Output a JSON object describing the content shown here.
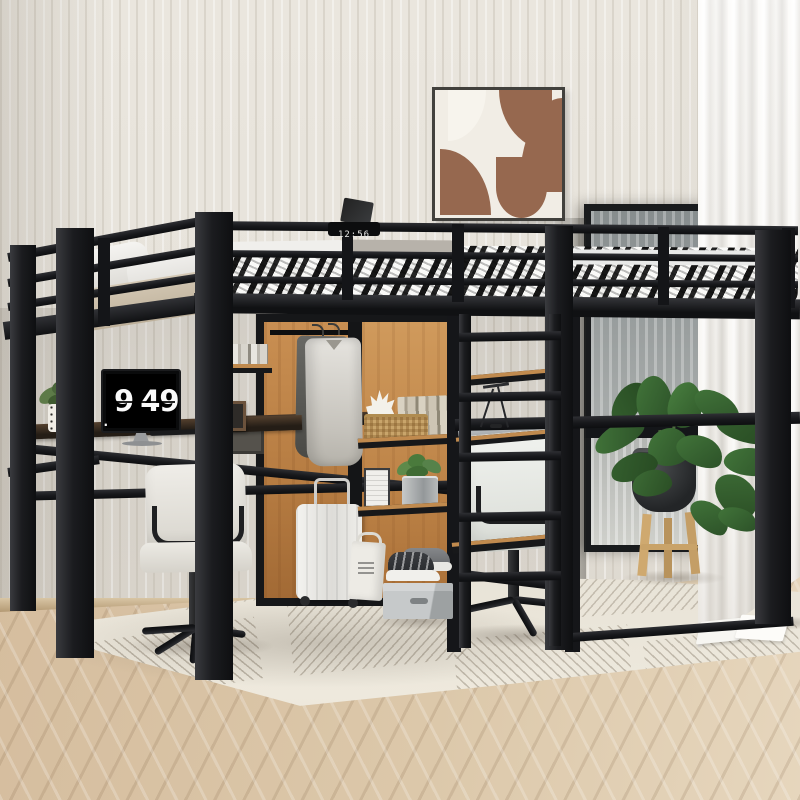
{
  "scene": {
    "title": "Black metal full-size loft bed with desks, wardrobe and shelves underneath",
    "setting": "bright bedroom with striped wallpaper, herringbone wood floor, cream area rug and a sheer-curtained black-framed window"
  },
  "bed": {
    "rail_clock_time": "12:56",
    "bedding": "black and white plaid comforter",
    "pillows": [
      "white",
      "tan"
    ],
    "frame": "black metal with guardrails and front ladder"
  },
  "monitor_clock": {
    "dot": ".",
    "hour": "9",
    "minute": "49"
  },
  "objects": {
    "left_desk": [
      "flip-clock monitor",
      "speckled plant pot",
      "wood photo frame",
      "cream office chair"
    ],
    "wardrobe": [
      "hanging rod",
      "light jacket",
      "dark jacket",
      "white suitcase",
      "tote bag",
      "book stack"
    ],
    "shelves": [
      "white coral",
      "wicker basket",
      "book row",
      "magazine file",
      "metal bucket plant",
      "desk lamp"
    ],
    "floor_items": [
      "grey storage box",
      "sneakers",
      "open magazine",
      "potted plant on wooden stand"
    ]
  },
  "palette": {
    "frame_black": "#17181b",
    "oak_panel": "#c08a4e",
    "wall": "#e9e5dd",
    "floor": "#d8c3a6",
    "rug": "#ebe6da",
    "curtain": "#f4f2ee",
    "artwork_brown": "#96684f",
    "leaf_green": "#3c6b38",
    "bedding_white": "#f0efec"
  }
}
